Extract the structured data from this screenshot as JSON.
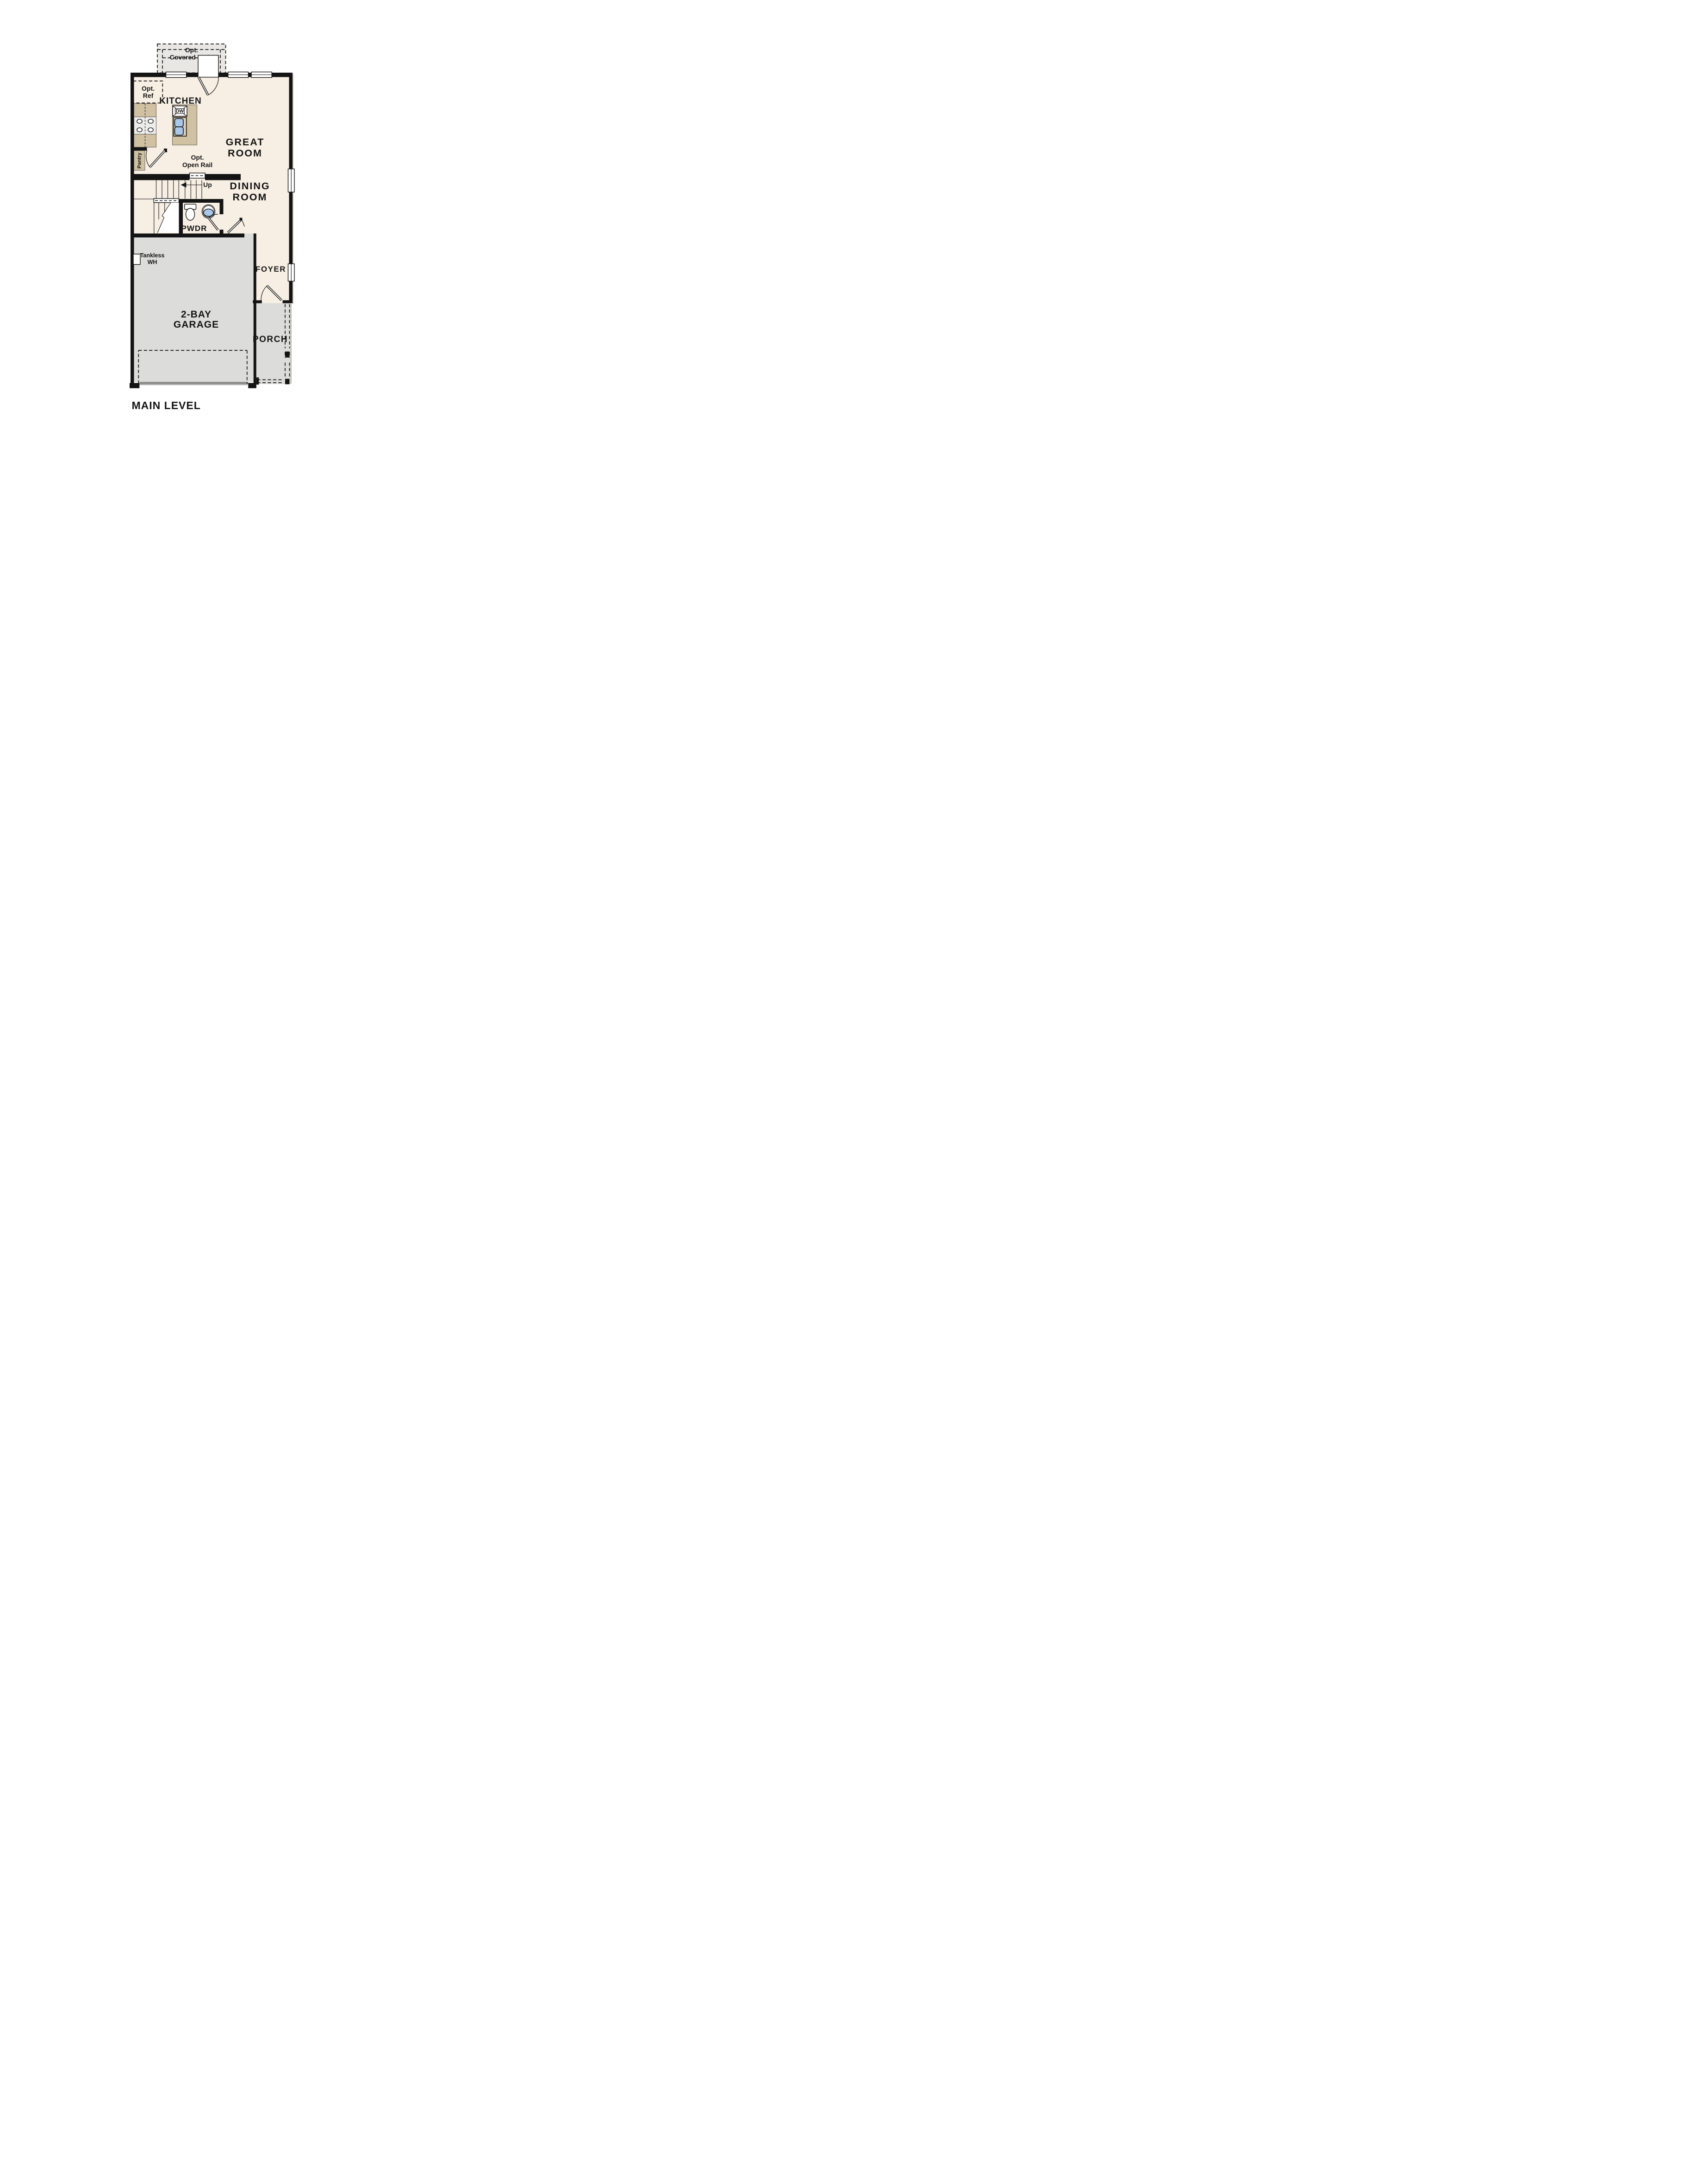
{
  "plan": {
    "title": "MAIN LEVEL",
    "rooms": {
      "kitchen": "KITCHEN",
      "great_room": [
        "GREAT",
        "ROOM"
      ],
      "dining_room": [
        "DINING",
        "ROOM"
      ],
      "foyer": "FOYER",
      "powder_room": "PWDR",
      "garage": [
        "2-BAY",
        "GARAGE"
      ],
      "porch": "PORCH",
      "pantry": "Pantry"
    },
    "annotations": {
      "covered_patio": [
        "Opt.",
        "Covered Patio"
      ],
      "optional_refrigerator": [
        "Opt.",
        "Ref"
      ],
      "optional_open_rail": [
        "Opt.",
        "Open Rail"
      ],
      "stairs_direction": "Up",
      "tankless_water_heater": [
        "Tankless",
        "WH"
      ],
      "dishwasher": "DW"
    },
    "colors": {
      "floor_cream": "#f7efe4",
      "patio_gray": "#e9e7e3",
      "garage_gray": "#dcdcda",
      "garage_apron_gray": "#8e8e8c",
      "cabinet_tan": "#cfc1a2",
      "fixture_blue": "#a9c7e8",
      "wall_black": "#141414"
    }
  }
}
